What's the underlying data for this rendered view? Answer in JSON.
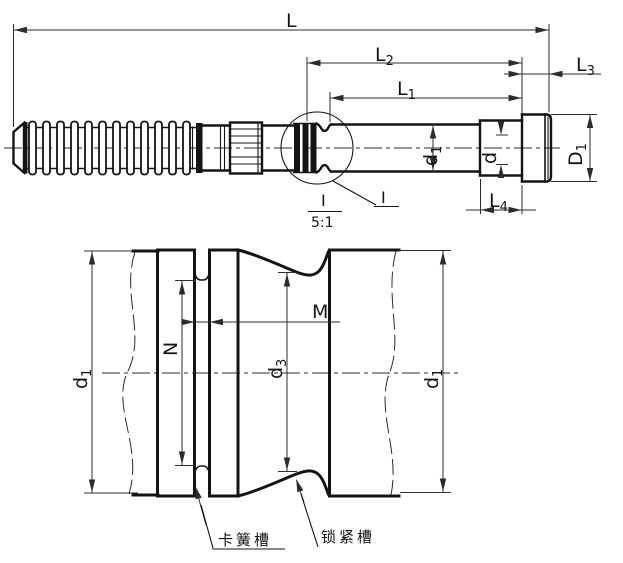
{
  "drawing": {
    "type": "engineering-drawing",
    "description": "Rope-thread drill rod shank, main view with magnified detail I (5:1)",
    "colors": {
      "background": "#ffffff",
      "line": "#141414"
    },
    "dims": {
      "L": {
        "base": "L",
        "sub": ""
      },
      "L1": {
        "base": "L",
        "sub": "1"
      },
      "L2": {
        "base": "L",
        "sub": "2"
      },
      "L3": {
        "base": "L",
        "sub": "3"
      },
      "L4": {
        "base": "L",
        "sub": "4"
      },
      "d1": {
        "base": "d",
        "sub": "1"
      },
      "d": {
        "base": "d",
        "sub": ""
      },
      "D1": {
        "base": "D",
        "sub": "1"
      },
      "N": {
        "base": "N",
        "sub": ""
      },
      "M": {
        "base": "M",
        "sub": ""
      },
      "d3": {
        "base": "d",
        "sub": "3"
      }
    },
    "detail": {
      "marker": "I",
      "title_marker": "I",
      "title_scale": "5:1"
    },
    "callouts": {
      "left": "卡簧槽",
      "right": "锁紧槽"
    }
  }
}
